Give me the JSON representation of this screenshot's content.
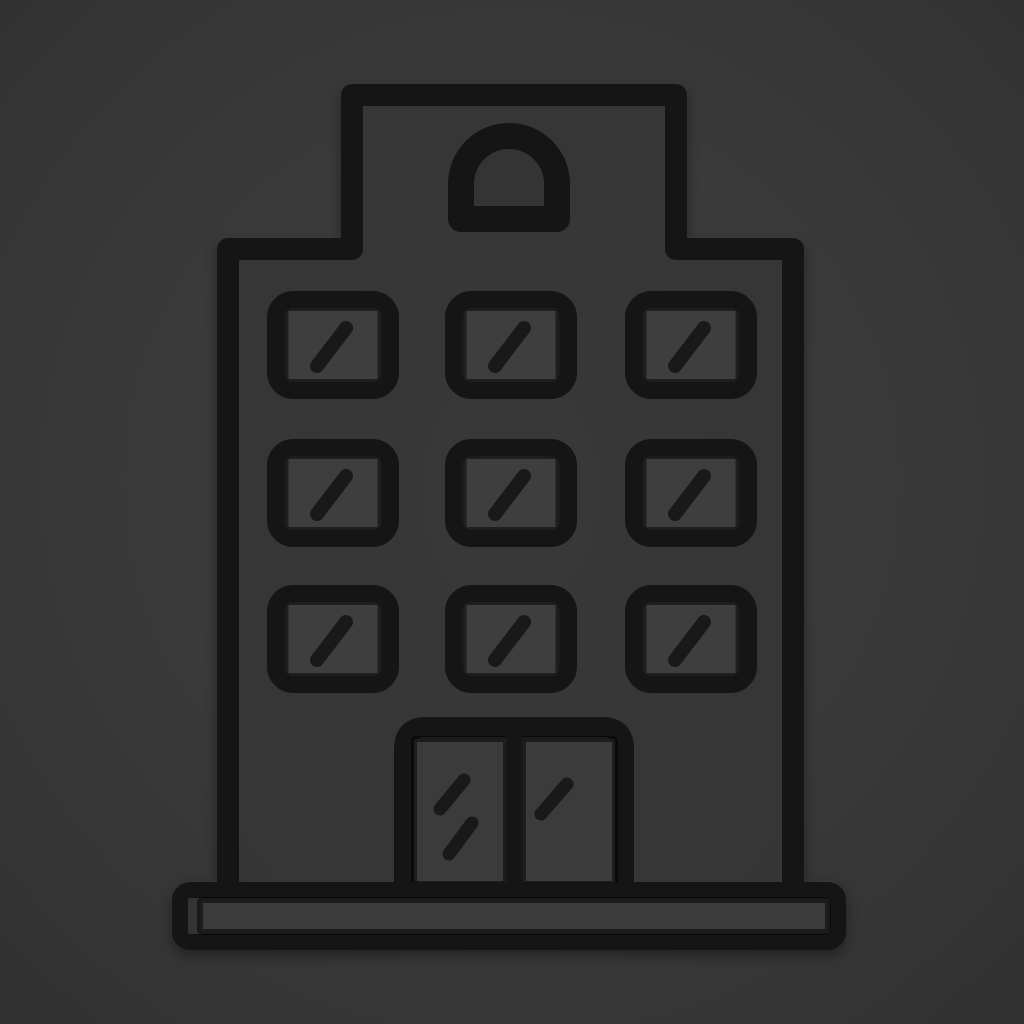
{
  "icon": {
    "name": "building-icon",
    "description": "thick dark outline icon of a multi-storey building on a dark gray background",
    "colors": {
      "background_center": "#3f3f3f",
      "background_mid": "#3a3a3a",
      "background_edge": "#313131",
      "stroke": "#151515",
      "slash": "#191919",
      "wall_fill": "#383838",
      "wall_fill_edge": "#353535",
      "arch_fill": "#343434",
      "window_pane_fill": "#3e3e3e",
      "door_panel_fill": "#3b3b3b",
      "door_frame_fill": "#363636",
      "base_fill": "#343434",
      "base_inner_fill": "#3b3b3b"
    },
    "structure": {
      "floors": 3,
      "windows_per_floor": 3,
      "window_slash_marks": 1,
      "tower_window_shape": "arched",
      "door_leaves": 2,
      "left_door_slash_marks": 2,
      "right_door_slash_marks": 1,
      "has_base_plinth": true
    }
  }
}
